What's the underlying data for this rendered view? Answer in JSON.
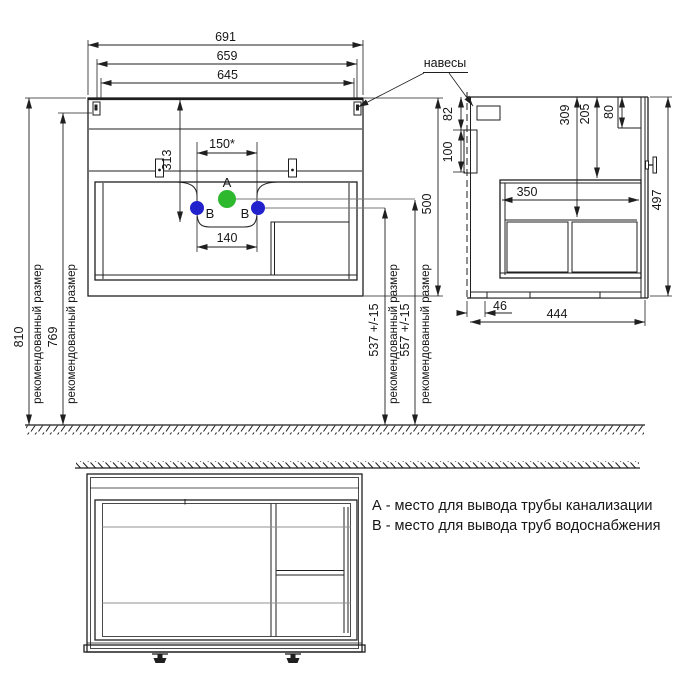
{
  "front_view": {
    "dim_overall_width": "691",
    "dim_hanger_width": "659",
    "dim_inner_width": "645",
    "dim_sink_axis": "313",
    "dim_faucet_span": "150*",
    "dim_pipe_span": "140",
    "dim_body_height": "500",
    "dim_mount_height_top": "810",
    "dim_mount_height_hangers": "769",
    "dim_pipe_b_height": "537 +/-15",
    "dim_pipe_a_height": "557 +/-15",
    "recommended_size_label": "рекомендованный размер",
    "hangers_label": "навесы",
    "point_a_label": "A",
    "point_b_label": "B"
  },
  "side_view": {
    "dim_top_rail_height": "82",
    "dim_hanger_height": "100",
    "dim_top_rail_depth": "80",
    "dim_box_top_offset": "205",
    "dim_drawer_top_offset": "309",
    "dim_inner_box_depth": "350",
    "dim_overall_height": "497",
    "dim_wall_gap": "46",
    "dim_overall_depth": "444"
  },
  "legend": {
    "item_a": "А - место для вывода трубы канализации",
    "item_b": "В - место для вывода труб водоснабжения"
  },
  "colors": {
    "line": "#1f1f1f",
    "point_a_fill": "#2eb82e",
    "point_b_fill": "#2222cc",
    "leader": "#7a7a7a",
    "shelf_line": "#909090"
  }
}
